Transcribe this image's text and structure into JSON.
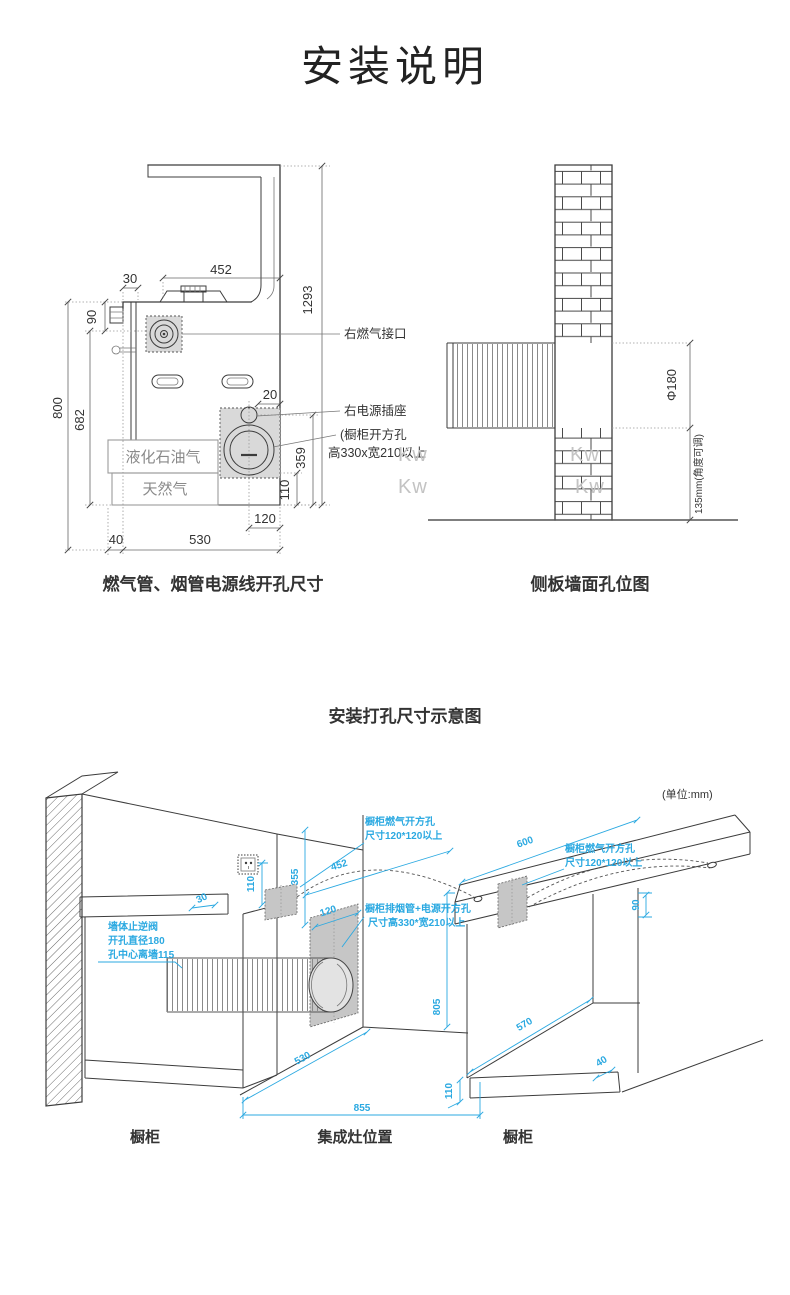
{
  "page": {
    "title": "安装说明"
  },
  "top_left": {
    "caption": "燃气管、烟管电源线开孔尺寸",
    "labels": {
      "gas_inlet": "右燃气接口",
      "power_socket": "右电源插座",
      "cabinet_hole_1": "(橱柜开方孔",
      "cabinet_hole_2": "高330x宽210以上",
      "lpg": "液化石油气",
      "natural_gas": "天然气"
    },
    "dims": {
      "d452": "452",
      "d30": "30",
      "d90": "90",
      "d1293": "1293",
      "d800": "800",
      "d682": "682",
      "d20": "20",
      "d359": "359",
      "d110": "110",
      "d120": "120",
      "d40": "40",
      "d530": "530"
    }
  },
  "top_right": {
    "caption": "侧板墙面孔位图",
    "dims": {
      "diameter": "Φ180",
      "height": "135mm(角度可调)"
    },
    "watermarks": [
      "Kw",
      "Kw",
      "Kw",
      "Kw"
    ]
  },
  "bottom": {
    "title": "安装打孔尺寸示意图",
    "unit_note": "(单位:mm)",
    "labels": {
      "left_gas_hole_1": "橱柜燃气开方孔",
      "left_gas_hole_2": "尺寸120*120以上",
      "right_gas_hole_1": "橱柜燃气开方孔",
      "right_gas_hole_2": "尺寸120*120以上",
      "flue_hole_1": "橱柜排烟管+电源开方孔",
      "flue_hole_2": "尺寸高330*宽210以上",
      "check_valve_1": "墙体止逆阀",
      "check_valve_2": "开孔直径180",
      "check_valve_3": "孔中心离墙115"
    },
    "dims": {
      "d30": "30",
      "d110_socket": "110",
      "d355": "355",
      "d452": "452",
      "d120": "120",
      "d600": "600",
      "d90": "90",
      "d805": "805",
      "d530": "530",
      "d855": "855",
      "d110_base": "110",
      "d570": "570",
      "d40": "40"
    },
    "captions": {
      "left": "橱柜",
      "center": "集成灶位置",
      "right": "橱柜"
    }
  }
}
